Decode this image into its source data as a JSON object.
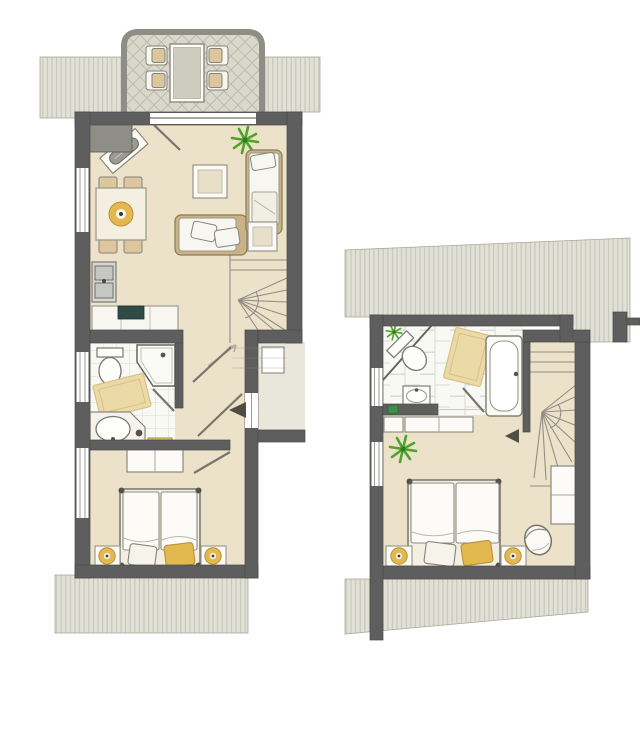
{
  "colors": {
    "background": "#ffffff",
    "wall_dark": "#5E5E5E",
    "wall_medium": "#8E8E86",
    "wall_outline": "#4A4A46",
    "floor": "#EBE2C9",
    "porch": "#E9E7DB",
    "tile": "#F8F8F4",
    "tile_line": "#DCDCD2",
    "roof": "#E1E1D7",
    "roof_stripe": "#C7C7B9",
    "terrace": "#D9D8CA",
    "terrace_line": "#BDBCAC",
    "wood": "#C8B286",
    "wood_dark": "#8B7A55",
    "cushion": "#F8F6F0",
    "accent_yellow": "#E3B94F",
    "accent_yellow_dark": "#B8913A",
    "mat_yellow": "#EBD9A8",
    "mat_border": "#D9C083",
    "plant": "#4FA32B",
    "plant_dark": "#2F7A1E",
    "cooktop": "#2E4B47",
    "stair_line": "#918F85",
    "door_line": "#77756D",
    "arrow": "#4F4D44",
    "towel_green": "#3E8E4E",
    "fixture_stroke": "#777777",
    "inner_panel": "#E7DFC8"
  },
  "floors": [
    {
      "id": "ground-floor",
      "rooms": [
        {
          "name": "terrace",
          "items": [
            "dining-table",
            "chair",
            "chair",
            "chair",
            "chair",
            "diamond-tile-floor"
          ]
        },
        {
          "name": "living-dining-room",
          "items": [
            "sideboard-diagonal",
            "plant",
            "dining-table",
            "chairs-4",
            "centerpiece-bowl",
            "coffee-table",
            "sofa",
            "cushions-2",
            "daybed",
            "side-table",
            "winder-staircase"
          ]
        },
        {
          "name": "kitchenette",
          "items": [
            "sink-unit",
            "counter",
            "cooktop"
          ]
        },
        {
          "name": "bathroom",
          "items": [
            "toilet",
            "corner-shower",
            "bath-mat",
            "vanity-basin",
            "radiator",
            "toilet-brush"
          ]
        },
        {
          "name": "hallway",
          "items": [
            "door-leaf",
            "door-leaf",
            "door-leaf"
          ]
        },
        {
          "name": "bedroom",
          "items": [
            "wardrobe",
            "double-bed",
            "pillow-white",
            "pillow-yellow",
            "nightstand",
            "nightstand",
            "lamp",
            "lamp"
          ]
        },
        {
          "name": "entry-porch",
          "items": [
            "entrance-arrow",
            "under-stair-closet"
          ]
        },
        {
          "name": "roof-areas",
          "items": [
            "roof-hatch-top-left",
            "roof-hatch-top-right",
            "roof-hatch-bottom"
          ]
        }
      ]
    },
    {
      "id": "upper-floor",
      "rooms": [
        {
          "name": "bathroom",
          "items": [
            "corner-toilet",
            "plant-small",
            "bath-mat",
            "bathtub",
            "washbasin",
            "towel",
            "half-wall"
          ]
        },
        {
          "name": "stair-hall",
          "items": [
            "winder-staircase",
            "direction-arrow"
          ]
        },
        {
          "name": "bedroom",
          "items": [
            "plant",
            "double-bed",
            "pillow-white",
            "pillow-yellow",
            "nightstand",
            "nightstand",
            "lamp",
            "lamp",
            "tub-chair",
            "shelf-unit",
            "closet",
            "closet"
          ]
        },
        {
          "name": "roof-areas",
          "items": [
            "roof-hatch-top",
            "roof-hatch-bottom"
          ]
        }
      ]
    }
  ]
}
